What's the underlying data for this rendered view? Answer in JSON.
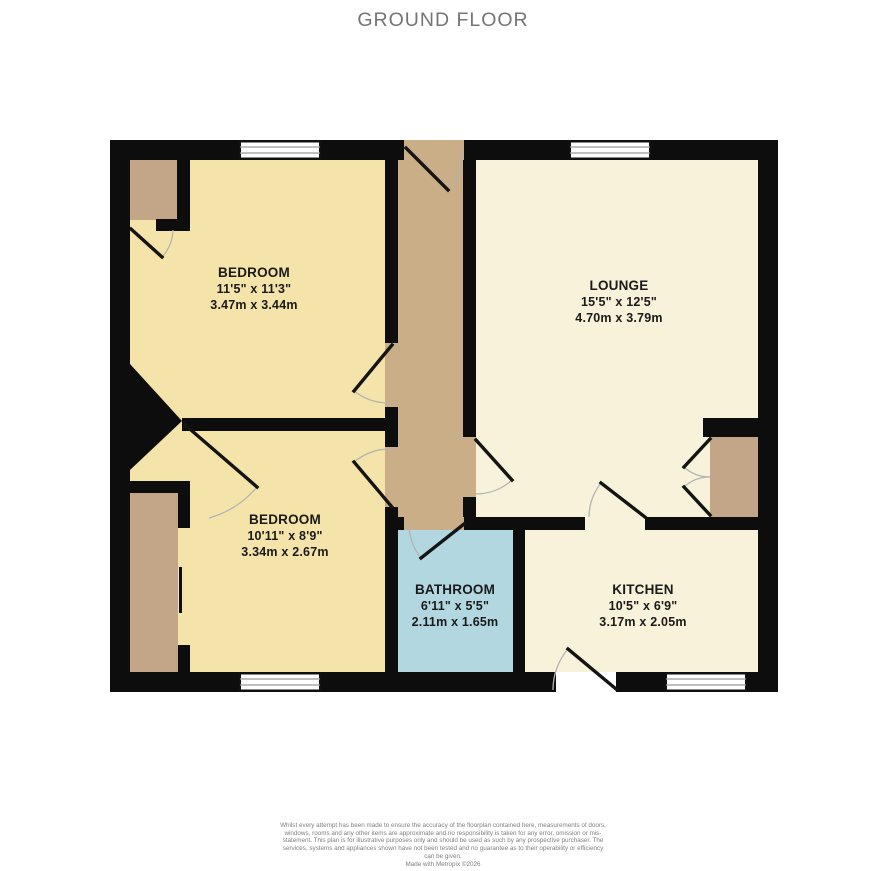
{
  "title": "GROUND FLOOR",
  "rooms": [
    {
      "name": "BEDROOM",
      "imperial": "11'5\" x 11'3\"",
      "metric": "3.47m x 3.44m"
    },
    {
      "name": "LOUNGE",
      "imperial": "15'5\" x 12'5\"",
      "metric": "4.70m x 3.79m"
    },
    {
      "name": "BEDROOM",
      "imperial": "10'11\" x 8'9\"",
      "metric": "3.34m x 2.67m"
    },
    {
      "name": "BATHROOM",
      "imperial": "6'11\" x 5'5\"",
      "metric": "2.11m x 1.65m"
    },
    {
      "name": "KITCHEN",
      "imperial": "10'5\" x 6'9\"",
      "metric": "3.17m x 2.05m"
    }
  ],
  "footer": {
    "disclaimer": "Whilst every attempt has been made to ensure the accuracy of the floorplan contained here, measurements of doors, windows, rooms and any other items are approximate and no responsibility is taken for any error, omission or mis-statement. This plan is for illustrative purposes only and should be used as such by any prospective purchaser. The services, systems and appliances shown have not been tested and no guarantee as to their operability or efficiency can be given.",
    "credit": "Made with Metropix ©2026"
  },
  "colors": {
    "wall": "#0d0d0d",
    "bedroom_fill": "#f5e4a9",
    "living_fill": "#f8f2da",
    "hall_fill": "#c9ae87",
    "closet_fill": "#c3a587",
    "bath_fill": "#b2d7e0",
    "window_pane": "#ffffff",
    "window_line": "#999999",
    "door_leaf": "#141414",
    "door_arc": "#b3b3b3",
    "title_text": "#757575",
    "label_text": "#1a1a1a",
    "disclaimer_text": "#808080"
  }
}
